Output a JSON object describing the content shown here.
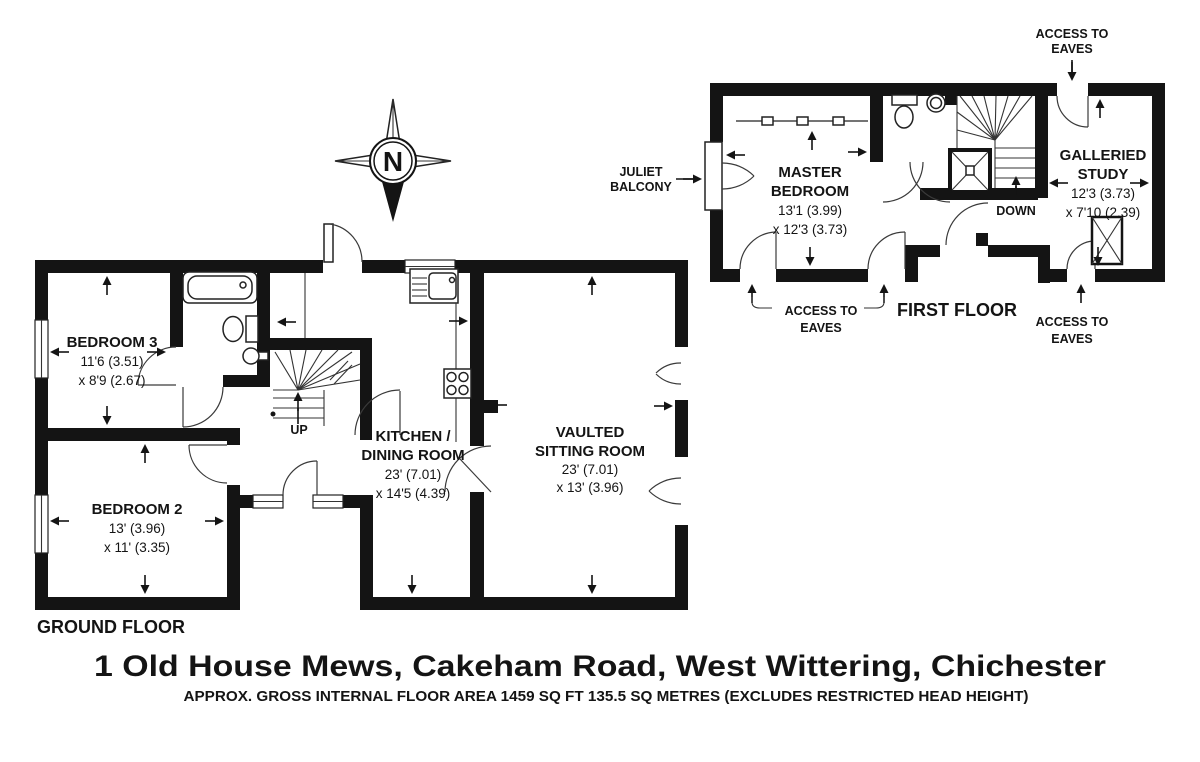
{
  "title": "1 Old House Mews, Cakeham Road, West Wittering, Chichester",
  "subtitle": "APPROX. GROSS INTERNAL FLOOR AREA 1459 SQ FT 135.5 SQ METRES (EXCLUDES RESTRICTED HEAD HEIGHT)",
  "compass": {
    "letter": "N"
  },
  "colors": {
    "wall": "#141414",
    "background": "#ffffff",
    "text": "#141414"
  },
  "ground_floor": {
    "label": "GROUND FLOOR",
    "stairs_label": "UP",
    "rooms": {
      "bedroom3": {
        "name": "BEDROOM 3",
        "dim1": "11'6 (3.51)",
        "dim2": "x 8'9 (2.67)"
      },
      "bedroom2": {
        "name": "BEDROOM 2",
        "dim1": "13' (3.96)",
        "dim2": "x 11' (3.35)"
      },
      "kitchen": {
        "name1": "KITCHEN /",
        "name2": "DINING ROOM",
        "dim1": "23' (7.01)",
        "dim2": "x 14'5 (4.39)"
      },
      "sitting": {
        "name1": "VAULTED",
        "name2": "SITTING ROOM",
        "dim1": "23' (7.01)",
        "dim2": "x 13' (3.96)"
      }
    }
  },
  "first_floor": {
    "label": "FIRST FLOOR",
    "stairs_label": "DOWN",
    "rooms": {
      "master": {
        "name1": "MASTER",
        "name2": "BEDROOM",
        "dim1": "13'1 (3.99)",
        "dim2": "x 12'3 (3.73)"
      },
      "study": {
        "name1": "GALLERIED",
        "name2": "STUDY",
        "dim1": "12'3 (3.73)",
        "dim2": "x 7'10 (2.39)"
      }
    },
    "juliet_balcony": {
      "line1": "JULIET",
      "line2": "BALCONY"
    },
    "eaves_top": {
      "line1": "ACCESS TO",
      "line2": "EAVES"
    },
    "eaves_left": {
      "line1": "ACCESS TO",
      "line2": "EAVES"
    },
    "eaves_right": {
      "line1": "ACCESS TO",
      "line2": "EAVES"
    }
  }
}
